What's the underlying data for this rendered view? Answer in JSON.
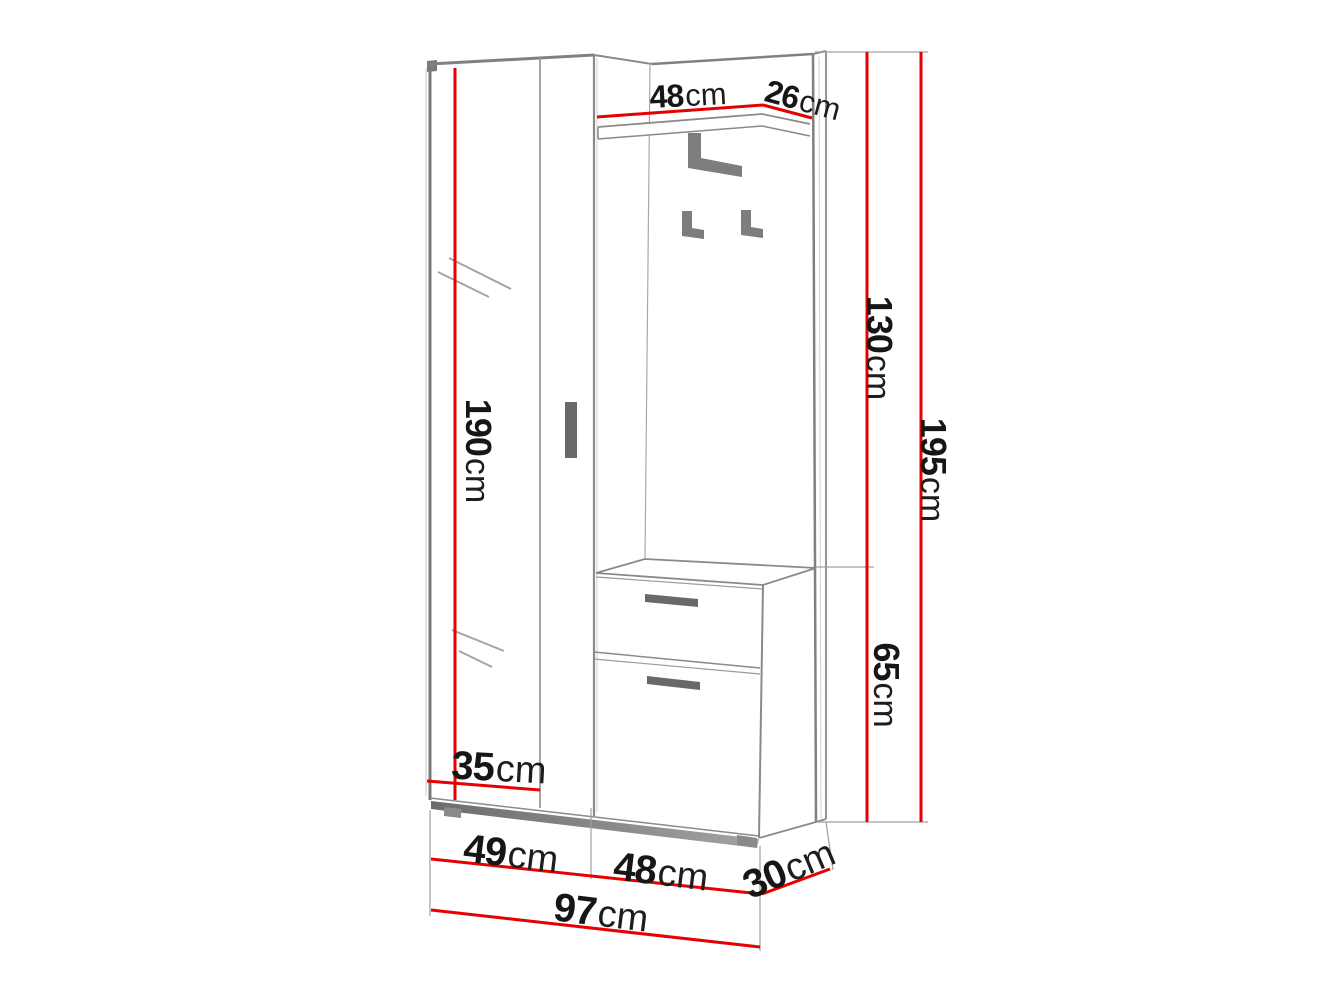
{
  "diagram": {
    "kind": "furniture dimension diagram",
    "subject": "hallway wardrobe set with mirror door, coat-hook panel, shelf and shoe cabinet",
    "unit": "cm",
    "colors": {
      "background": "#ffffff",
      "dimension_line": "#e60000",
      "outline": "#8a8a8a",
      "hardware": "#696969",
      "text": "#161616"
    }
  },
  "labels": {
    "shelf_width": {
      "value": "48",
      "unit": "cm"
    },
    "shelf_depth": {
      "value": "26",
      "unit": "cm"
    },
    "upper_height": {
      "value": "130",
      "unit": "cm"
    },
    "total_height": {
      "value": "195",
      "unit": "cm"
    },
    "door_height": {
      "value": "190",
      "unit": "cm"
    },
    "cabinet_height": {
      "value": "65",
      "unit": "cm"
    },
    "wardrobe_depth": {
      "value": "35",
      "unit": "cm"
    },
    "wardrobe_width": {
      "value": "49",
      "unit": "cm"
    },
    "cabinet_width": {
      "value": "48",
      "unit": "cm"
    },
    "cabinet_depth": {
      "value": "30",
      "unit": "cm"
    },
    "total_width": {
      "value": "97",
      "unit": "cm"
    }
  }
}
